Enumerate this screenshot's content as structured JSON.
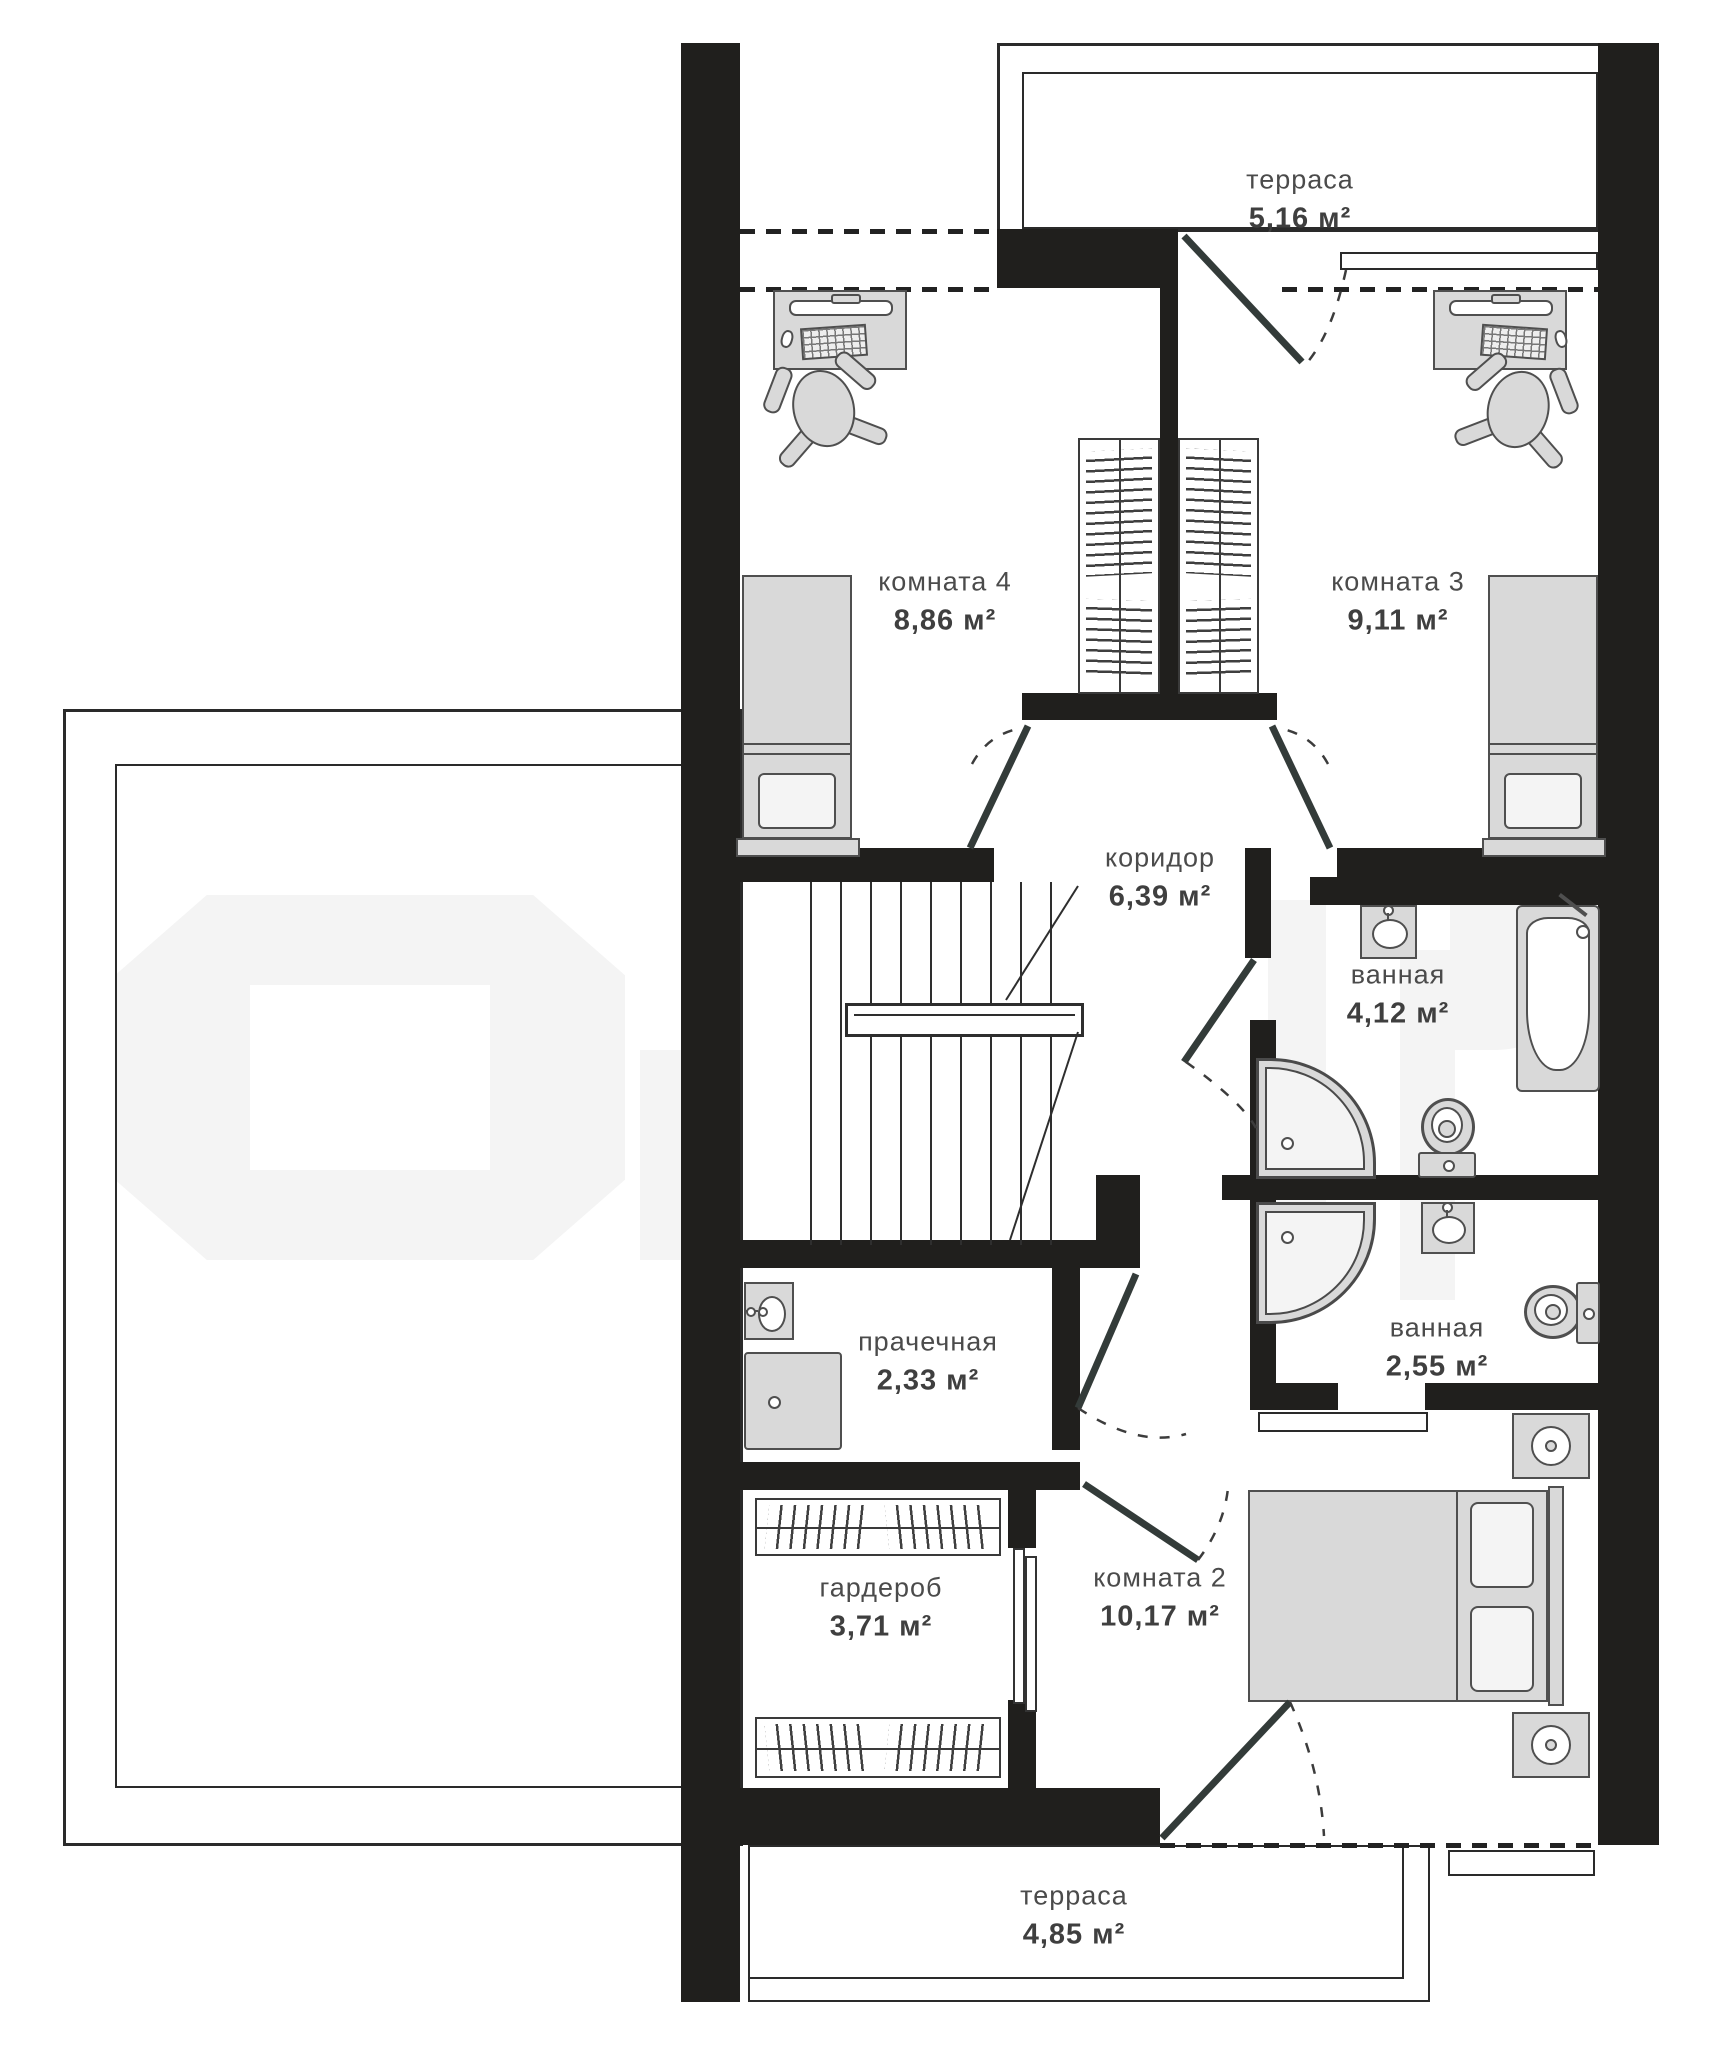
{
  "plan_type": "floor-plan",
  "watermark": {
    "present": true,
    "color": "#f4f4f4"
  },
  "rooms": [
    {
      "key": "terrace-top",
      "name": "терраса",
      "area": "5,16 м²"
    },
    {
      "key": "room-4",
      "name": "комната 4",
      "area": "8,86 м²"
    },
    {
      "key": "room-3",
      "name": "комната 3",
      "area": "9,11 м²"
    },
    {
      "key": "corridor",
      "name": "коридор",
      "area": "6,39 м²"
    },
    {
      "key": "bathroom-1",
      "name": "ванная",
      "area": "4,12 м²"
    },
    {
      "key": "laundry",
      "name": "прачечная",
      "area": "2,33 м²"
    },
    {
      "key": "bathroom-2",
      "name": "ванная",
      "area": "2,55 м²"
    },
    {
      "key": "wardrobe-room",
      "name": "гардероб",
      "area": "3,71 м²"
    },
    {
      "key": "room-2",
      "name": "комната 2",
      "area": "10,17 м²"
    },
    {
      "key": "terrace-bottom",
      "name": "терраса",
      "area": "4,85 м²"
    }
  ],
  "fixtures": [
    "desk-icon",
    "office-chair-icon",
    "single-bed-icon",
    "wardrobe-icon",
    "wardrobe-icon",
    "desk-icon",
    "office-chair-icon",
    "single-bed-icon",
    "stairs-icon",
    "railing-icon",
    "sink-icon",
    "bathtub-icon",
    "shower-icon",
    "toilet-icon",
    "sink-icon",
    "shower-icon",
    "toilet-icon",
    "sink-icon",
    "washing-machine-icon",
    "hanging-rail-icon",
    "hanging-rail-icon",
    "sliding-door-icon",
    "double-bed-icon",
    "nightstand-icon",
    "nightstand-icon",
    "door-leaf-icon",
    "door-leaf-icon",
    "door-leaf-icon",
    "door-leaf-icon",
    "door-leaf-icon",
    "door-leaf-icon",
    "door-leaf-icon"
  ],
  "colors": {
    "wall": "#201f1d",
    "furniture_fill": "#d9d9d9",
    "furniture_stroke": "#4f4f4f",
    "label_text": "#4b4b4b",
    "thin_line": "#2a2a2a",
    "door": "#333b39",
    "watermark": "#f4f4f4"
  }
}
